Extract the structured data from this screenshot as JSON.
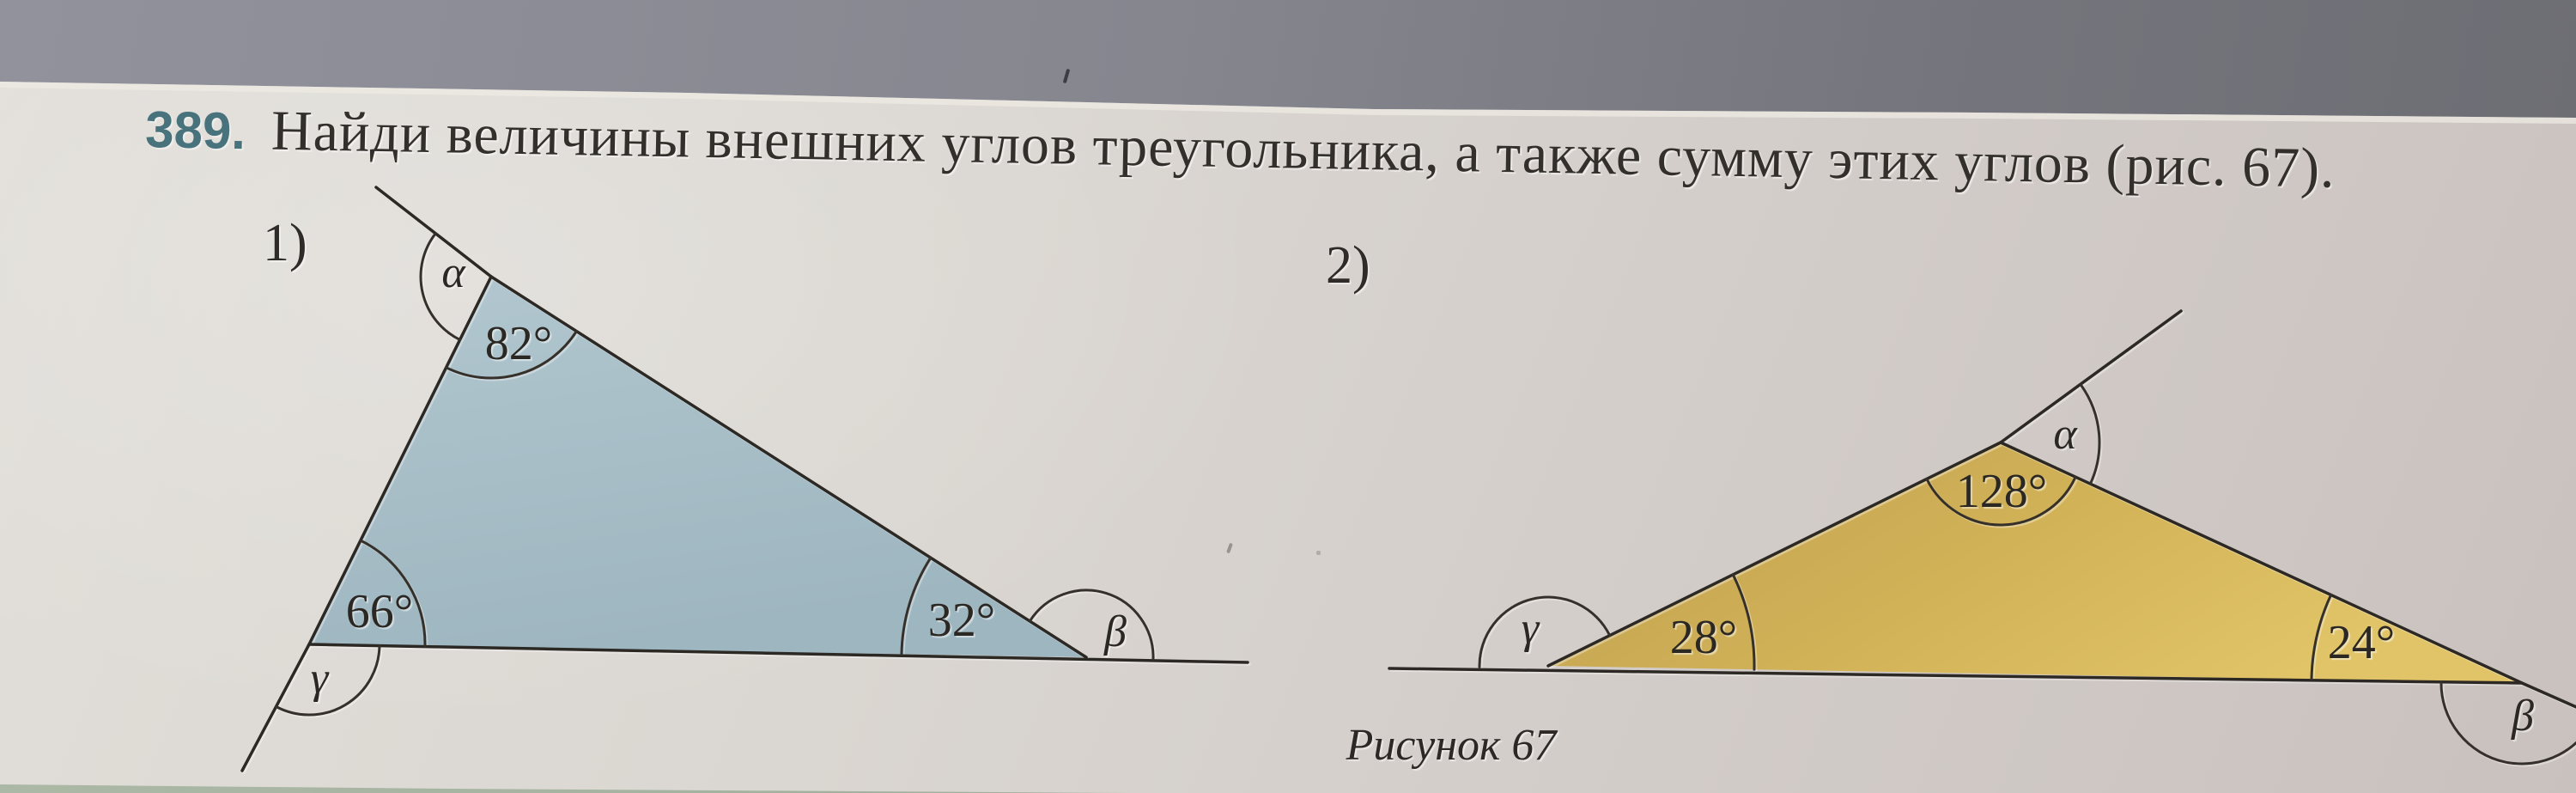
{
  "problem": {
    "number": "389.",
    "statement": "Найди величины внешних углов треугольника, а также сумму этих углов (рис. 67).",
    "figure_caption": "Рисунок 67"
  },
  "figures": [
    {
      "label": "1)",
      "fill_color": "#a7bfc8",
      "angles": {
        "top_interior": "82°",
        "bottom_left_interior": "66°",
        "bottom_right_interior": "32°",
        "top_exterior": "α",
        "bottom_left_exterior": "γ",
        "bottom_right_exterior": "β"
      }
    },
    {
      "label": "2)",
      "fill_color": "#d7b75c",
      "angles": {
        "top_interior": "128°",
        "bottom_left_interior": "28°",
        "bottom_right_interior": "24°",
        "top_exterior": "α",
        "bottom_left_exterior": "γ",
        "bottom_right_exterior": "β"
      }
    }
  ],
  "colors": {
    "problem_number_accent": "#48737c",
    "page_background": "#d8d4cf",
    "photo_band": "#7c7c86",
    "line_ink": "#2c2824",
    "triangle1_fill": "#a7bfc8",
    "triangle2_fill": "#d7b75c"
  }
}
